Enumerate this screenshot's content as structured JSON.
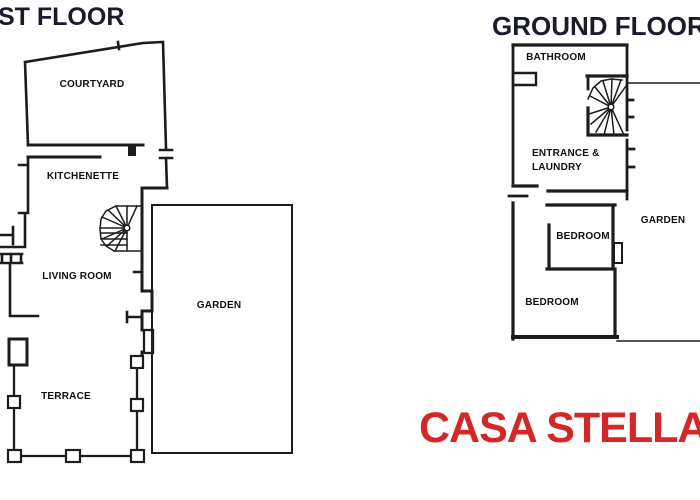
{
  "floor_plans": {
    "first_floor": {
      "title": "ST FLOOR",
      "rooms": {
        "courtyard": "COURTYARD",
        "kitchenette": "KITCHENETTE",
        "living_room": "LIVING ROOM",
        "garden": "GARDEN",
        "terrace": "TERRACE"
      }
    },
    "ground_floor": {
      "title": "GROUND FLOOR",
      "rooms": {
        "bathroom": "BATHROOM",
        "entrance_laundry_line1": "ENTRANCE &",
        "entrance_laundry_line2": "LAUNDRY",
        "bedroom_upper": "BEDROOM",
        "bedroom_lower": "BEDROOM",
        "garden": "GARDEN"
      }
    }
  },
  "caption": {
    "property_name": "CASA STELLA"
  },
  "colors": {
    "wall": "#1c1c1c",
    "floor_title": "#1b1b2e",
    "caption_red": "#d42727",
    "background": "#ffffff"
  }
}
